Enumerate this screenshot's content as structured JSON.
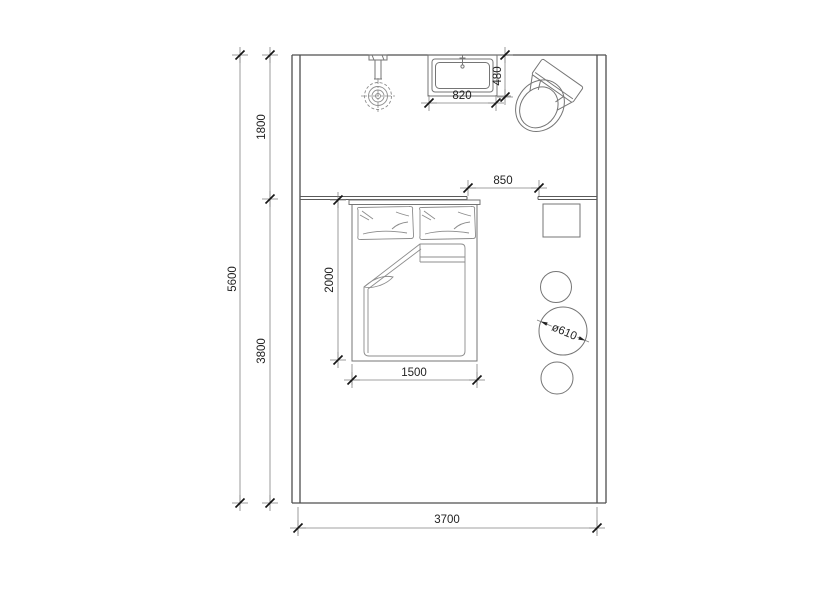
{
  "meta": {
    "drawing_type": "bedroom floor plan",
    "background_color": "#ffffff",
    "wall_color": "#4f4f4f",
    "furniture_line_color": "#757575",
    "dimension_text_color": "#222222"
  },
  "plan": {
    "labels": {
      "dim_total_height": "5600",
      "dim_upper_zone": "1800",
      "dim_lower_zone": "3800",
      "dim_room_width": "3700",
      "dim_opening": "850",
      "dim_basin_width": "820",
      "dim_basin_depth": "480",
      "dim_bed_length": "2000",
      "dim_bed_width": "1500",
      "dim_table_diameter": "ø610"
    }
  }
}
